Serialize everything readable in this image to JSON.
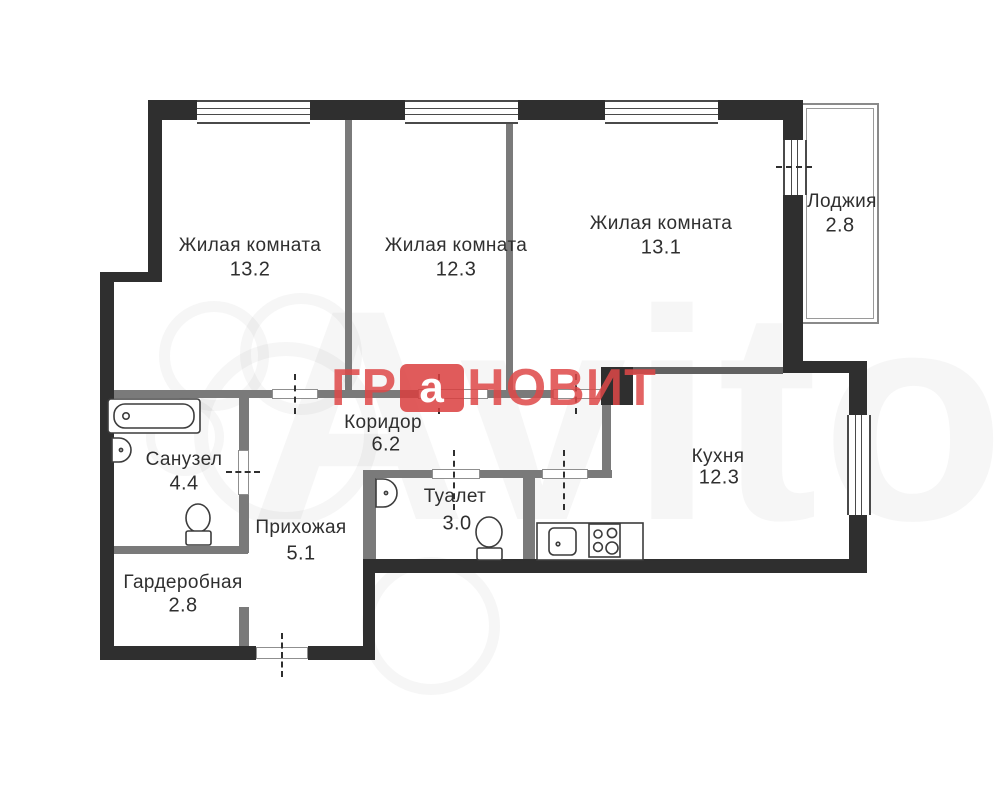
{
  "logo": {
    "left": "ГР",
    "mark": "а",
    "right": "НОВИТ",
    "red": "#db3e3e"
  },
  "watermark": {
    "text": "Avito"
  },
  "rooms": [
    {
      "name": "Жилая комната",
      "area": "13.2"
    },
    {
      "name": "Жилая комната",
      "area": "12.3"
    },
    {
      "name": "Жилая комната",
      "area": "13.1"
    },
    {
      "name": "Лоджия",
      "area": "2.8"
    },
    {
      "name": "Коридор",
      "area": "6.2"
    },
    {
      "name": "Санузел",
      "area": "4.4"
    },
    {
      "name": "Прихожая",
      "area": "5.1"
    },
    {
      "name": "Гардеробная",
      "area": "2.8"
    },
    {
      "name": "Туалет",
      "area": "3.0"
    },
    {
      "name": "Кухня",
      "area": "12.3"
    }
  ],
  "colors": {
    "exterior_wall": "#2f2f2f",
    "interior_wall": "#7a7a7a",
    "logo_red": "#db3e3e",
    "label_text": "#2f2f2f"
  }
}
